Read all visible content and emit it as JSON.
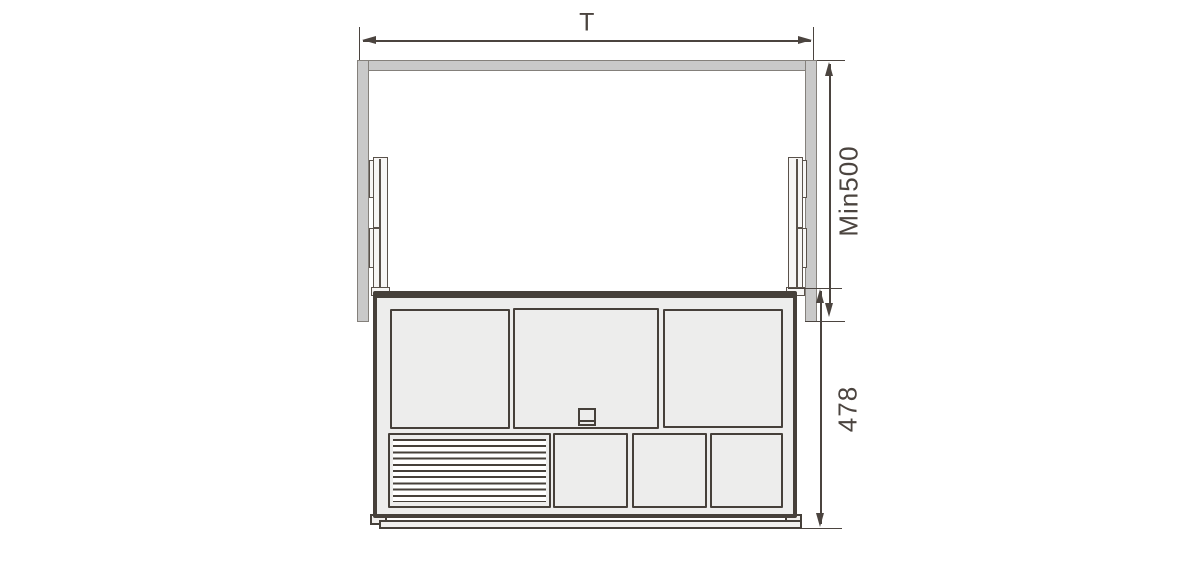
{
  "drawing": {
    "type": "technical-dimension-diagram",
    "subject": "pull-out cabinet drawer with side slide rails, front view",
    "dimensions": {
      "width_label": "T",
      "upper_height_label": "Min500",
      "lower_height_label": "478"
    },
    "colors": {
      "frame_fill": "#c9c9c9",
      "frame_outline": "#84807b",
      "drawer_outline": "#46403a",
      "dimension_lines": "#4b443f",
      "panel_fill": "#ededec",
      "background": "#ffffff"
    }
  }
}
